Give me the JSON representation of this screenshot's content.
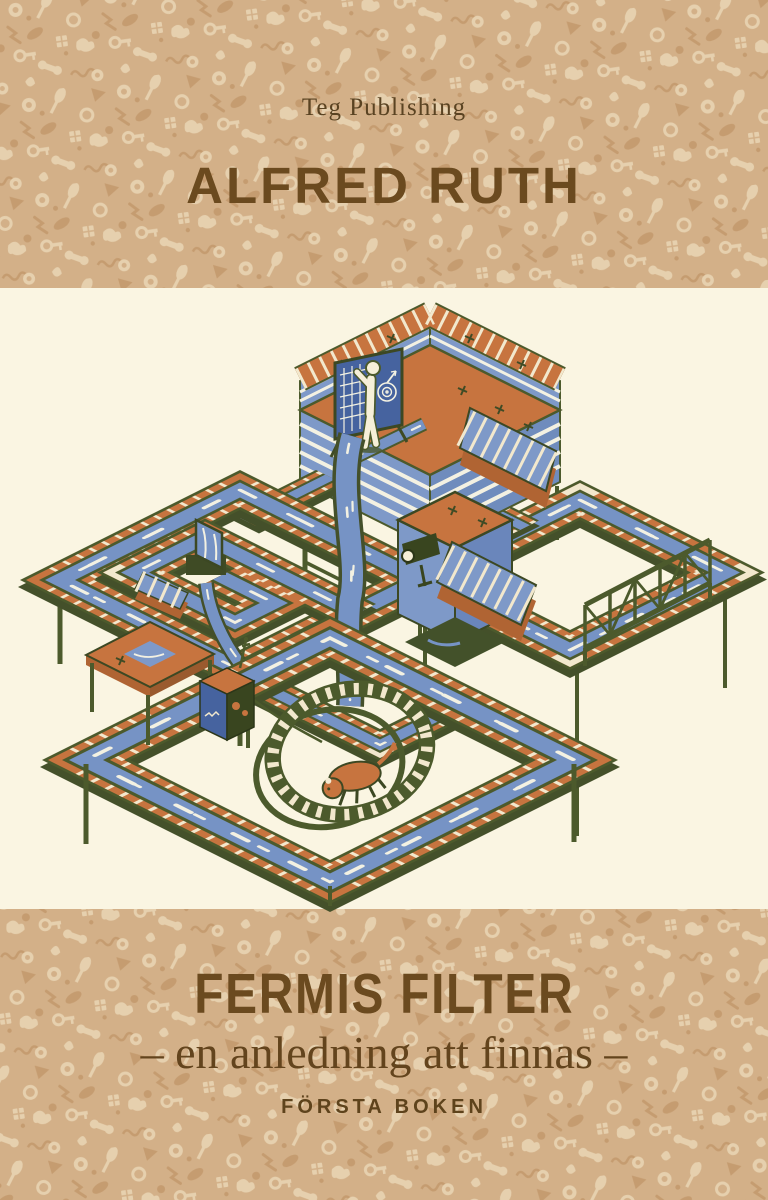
{
  "cover": {
    "publisher": "Teg Publishing",
    "author": "ALFRED RUTH",
    "title": "FERMIS FILTER",
    "subtitle": "– en anledning att finnas –",
    "series": "FÖRSTA BOKEN"
  },
  "colors": {
    "pattern_base": "#d3b088",
    "pattern_motif_light": "#e6d0ae",
    "pattern_motif_dark": "#c59c70",
    "panel_cream": "#faf5e2",
    "text_brown": "#64431d",
    "ink_orange": "#c7743f",
    "ink_blue": "#7e99c8",
    "ink_water": "#7693c5",
    "ink_olive": "#4c5a2c",
    "ink_dark_olive": "#3f4b25"
  },
  "illustration": {
    "name": "isometric-water-maze",
    "elements": [
      "water channels",
      "waterfall",
      "figure at chart board",
      "staircases",
      "camera tower",
      "truss bridge",
      "running wheel with rodent",
      "control box"
    ]
  }
}
